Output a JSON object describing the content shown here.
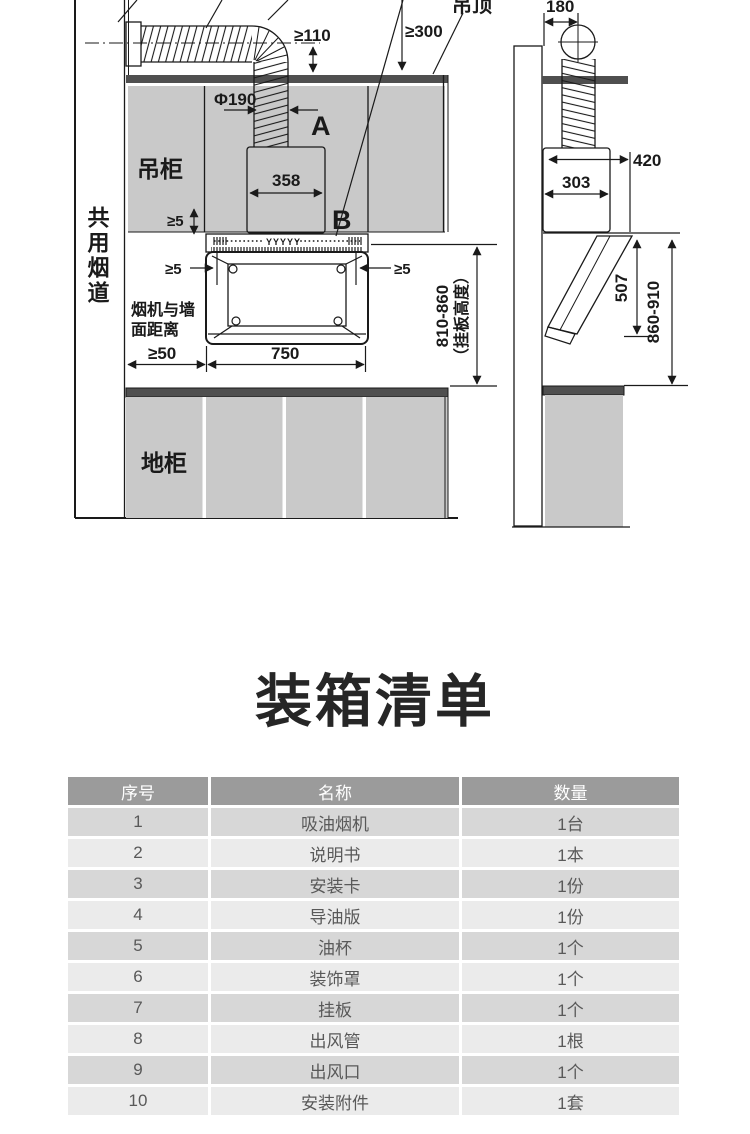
{
  "title": "装箱清单",
  "colors": {
    "cabinet_grey": "#c9c9c9",
    "counter_dark": "#4f4f4f",
    "line": "#1a1a1a",
    "table_header_bg": "#9b9b9b",
    "table_row_dark": "#d7d7d7",
    "table_row_light": "#ebebeb",
    "table_text": "#595959"
  },
  "diagram": {
    "labels": {
      "ceiling": "吊顶",
      "min_110": "≥110",
      "min_300": "≥300",
      "dim_180": "180",
      "duct_dia": "Φ190",
      "letter_a": "A",
      "letter_b": "B",
      "upper_cabinet": "吊柜",
      "dim_358": "358",
      "min_5": "≥5",
      "shared_flue": "共用烟道",
      "hood_wall_line1": "烟机与墙",
      "hood_wall_line2": "面距离",
      "min_50": "≥50",
      "dim_750": "750",
      "dim_303": "303",
      "dim_420": "420",
      "dim_507": "507",
      "dim_860_910": "860-910",
      "plate_height_range": "810-860",
      "plate_height_note": "（挂板高度）",
      "base_cabinet": "地柜",
      "vent_marks": "YYYYY"
    }
  },
  "packing_list": {
    "headers": [
      "序号",
      "名称",
      "数量"
    ],
    "rows": [
      {
        "no": "1",
        "name": "吸油烟机",
        "qty": "1台"
      },
      {
        "no": "2",
        "name": "说明书",
        "qty": "1本"
      },
      {
        "no": "3",
        "name": "安装卡",
        "qty": "1份"
      },
      {
        "no": "4",
        "name": "导油版",
        "qty": "1份"
      },
      {
        "no": "5",
        "name": "油杯",
        "qty": "1个"
      },
      {
        "no": "6",
        "name": "装饰罩",
        "qty": "1个"
      },
      {
        "no": "7",
        "name": "挂板",
        "qty": "1个"
      },
      {
        "no": "8",
        "name": "出风管",
        "qty": "1根"
      },
      {
        "no": "9",
        "name": "出风口",
        "qty": "1个"
      },
      {
        "no": "10",
        "name": "安装附件",
        "qty": "1套"
      }
    ]
  }
}
